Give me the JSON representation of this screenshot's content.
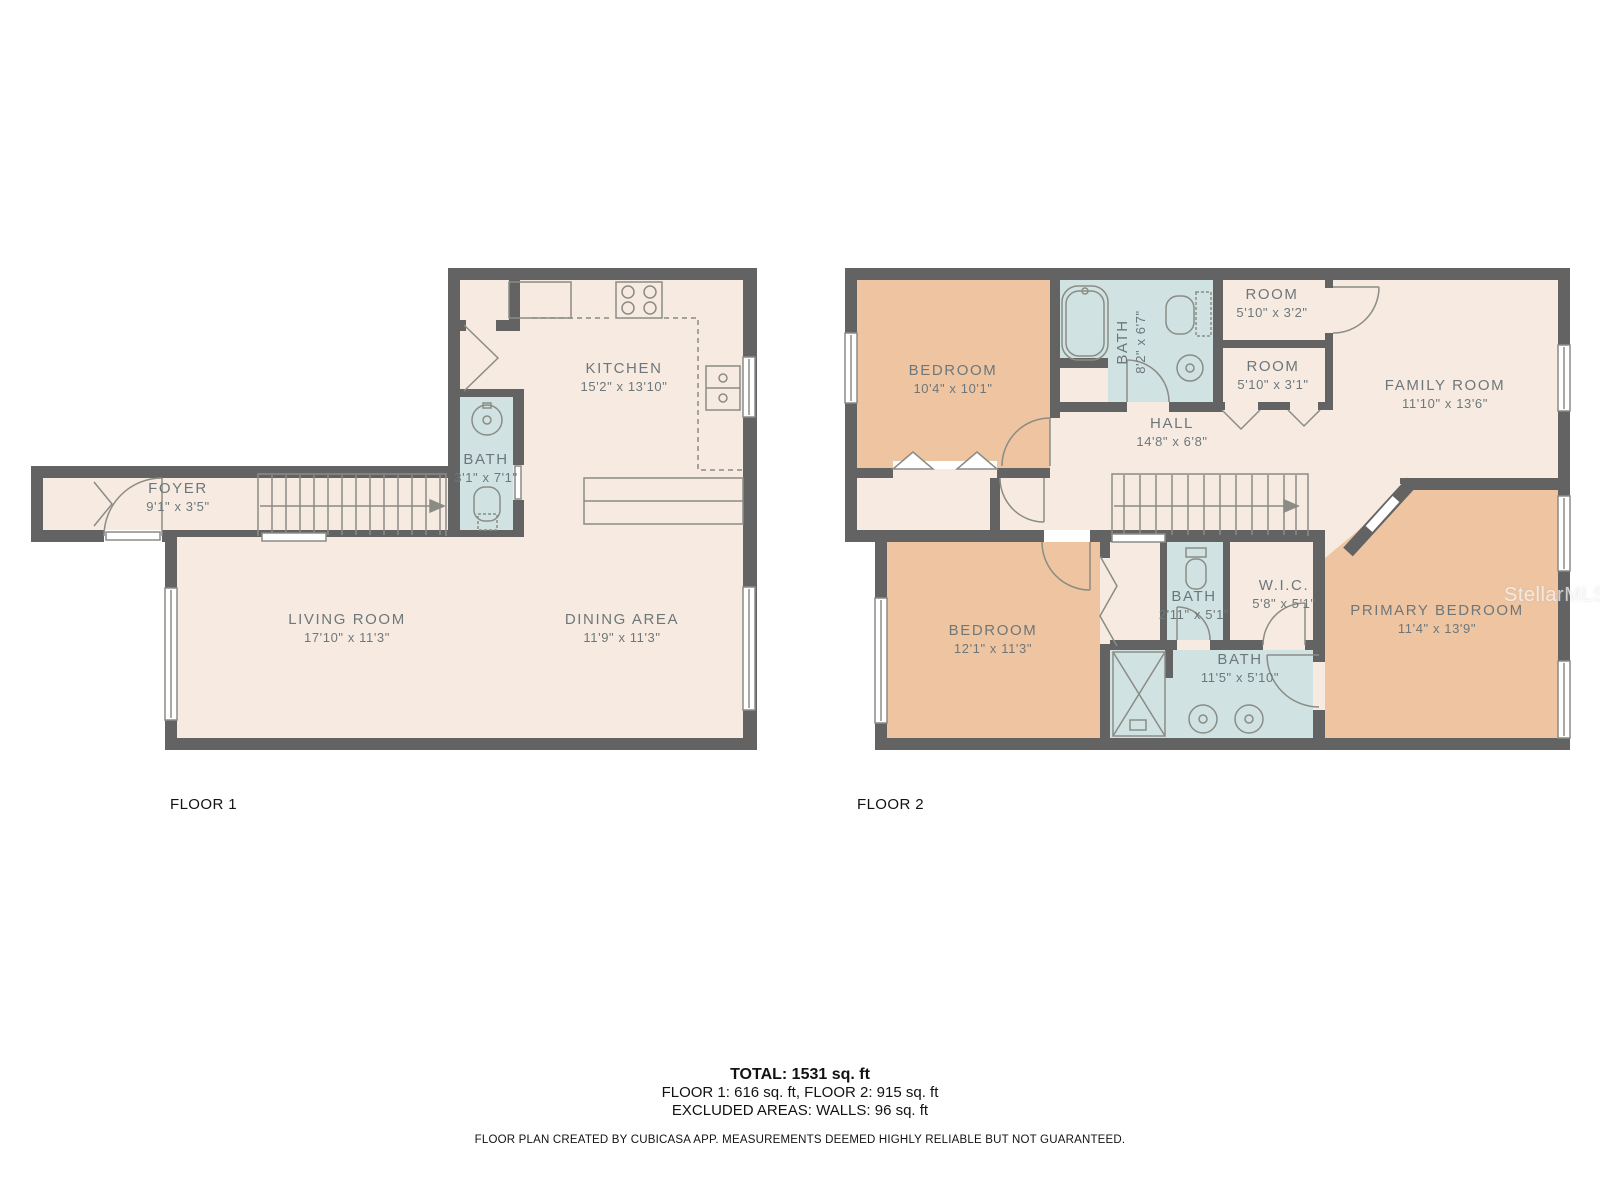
{
  "colors": {
    "wall": "#636363",
    "floor_default": "#f7ebe1",
    "floor_bedroom": "#efc5a1",
    "floor_bath": "#d0e2e2",
    "label_text": "#6d777b",
    "fixture_line": "#8a8c85"
  },
  "floor1": {
    "label": "FLOOR 1",
    "rooms": [
      {
        "name": "KITCHEN",
        "dims": "15'2\" x 13'10\""
      },
      {
        "name": "BATH",
        "dims": "3'1\" x 7'1\""
      },
      {
        "name": "FOYER",
        "dims": "9'1\" x 3'5\""
      },
      {
        "name": "LIVING ROOM",
        "dims": "17'10\" x 11'3\""
      },
      {
        "name": "DINING AREA",
        "dims": "11'9\" x 11'3\""
      }
    ]
  },
  "floor2": {
    "label": "FLOOR 2",
    "rooms": [
      {
        "name": "BEDROOM",
        "dims": "10'4\" x 10'1\""
      },
      {
        "name": "BATH",
        "dims": "8'2\" x 6'7\""
      },
      {
        "name": "ROOM",
        "dims": "5'10\" x 3'2\""
      },
      {
        "name": "ROOM",
        "dims": "5'10\" x 3'1\""
      },
      {
        "name": "FAMILY ROOM",
        "dims": "11'10\" x 13'6\""
      },
      {
        "name": "HALL",
        "dims": "14'8\" x 6'8\""
      },
      {
        "name": "BEDROOM",
        "dims": "12'1\" x 11'3\""
      },
      {
        "name": "BATH",
        "dims": "2'11\" x 5'1\""
      },
      {
        "name": "W.I.C.",
        "dims": "5'8\" x 5'1\""
      },
      {
        "name": "BATH",
        "dims": "11'5\" x 5'10\""
      },
      {
        "name": "PRIMARY BEDROOM",
        "dims": "11'4\" x 13'9\""
      }
    ]
  },
  "summary": {
    "total": "TOTAL: 1531 sq. ft",
    "floors": "FLOOR 1: 616 sq. ft, FLOOR 2: 915 sq. ft",
    "excluded": "EXCLUDED AREAS: WALLS: 96 sq. ft",
    "disclaimer": "FLOOR PLAN CREATED BY CUBICASA APP. MEASUREMENTS DEEMED HIGHLY RELIABLE BUT NOT GUARANTEED."
  },
  "watermark": "StellarMLS"
}
